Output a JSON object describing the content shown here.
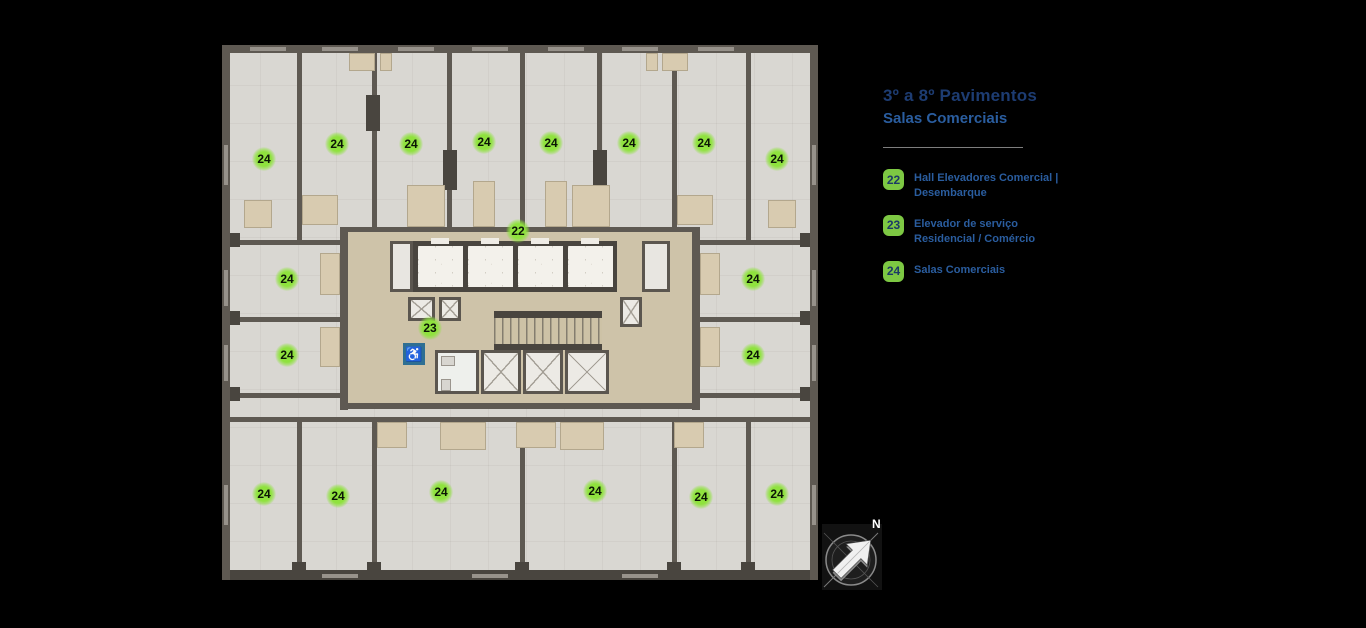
{
  "title": {
    "line1": "3º a 8º Pavimentos",
    "line2": "Salas Comerciais"
  },
  "legend": {
    "items": [
      {
        "number": "22",
        "lines": [
          "Hall Elevadores Comercial |",
          "Desembarque"
        ]
      },
      {
        "number": "23",
        "lines": [
          "Elevador de serviço",
          "Residencial / Comércio"
        ]
      },
      {
        "number": "24",
        "lines": [
          "Salas Comerciais"
        ]
      }
    ]
  },
  "plan": {
    "accessible_symbol": "♿",
    "markers": [
      {
        "label": "24",
        "x": 264,
        "y": 159
      },
      {
        "label": "24",
        "x": 337,
        "y": 144
      },
      {
        "label": "24",
        "x": 411,
        "y": 144
      },
      {
        "label": "24",
        "x": 484,
        "y": 142
      },
      {
        "label": "24",
        "x": 551,
        "y": 143
      },
      {
        "label": "24",
        "x": 629,
        "y": 143
      },
      {
        "label": "24",
        "x": 704,
        "y": 143
      },
      {
        "label": "24",
        "x": 777,
        "y": 159
      },
      {
        "label": "22",
        "x": 518,
        "y": 231
      },
      {
        "label": "24",
        "x": 287,
        "y": 279
      },
      {
        "label": "24",
        "x": 753,
        "y": 279
      },
      {
        "label": "23",
        "x": 430,
        "y": 328
      },
      {
        "label": "24",
        "x": 287,
        "y": 355
      },
      {
        "label": "24",
        "x": 753,
        "y": 355
      },
      {
        "label": "24",
        "x": 264,
        "y": 494
      },
      {
        "label": "24",
        "x": 338,
        "y": 496
      },
      {
        "label": "24",
        "x": 441,
        "y": 492
      },
      {
        "label": "24",
        "x": 595,
        "y": 491
      },
      {
        "label": "24",
        "x": 701,
        "y": 497
      },
      {
        "label": "24",
        "x": 777,
        "y": 494
      }
    ]
  },
  "compass": {
    "label": "N"
  },
  "colors": {
    "background": "#000000",
    "title_navy": "#1d3c72",
    "legend_blue": "#2a5d9f",
    "legend_badge_green": "#7dc843",
    "marker_green": "#8fe23e",
    "wall_gray": "#5e5952",
    "floor_gray": "#d9d7d2",
    "niche_tan": "#d8cbb0",
    "accessible_blue": "#2e6f93"
  }
}
